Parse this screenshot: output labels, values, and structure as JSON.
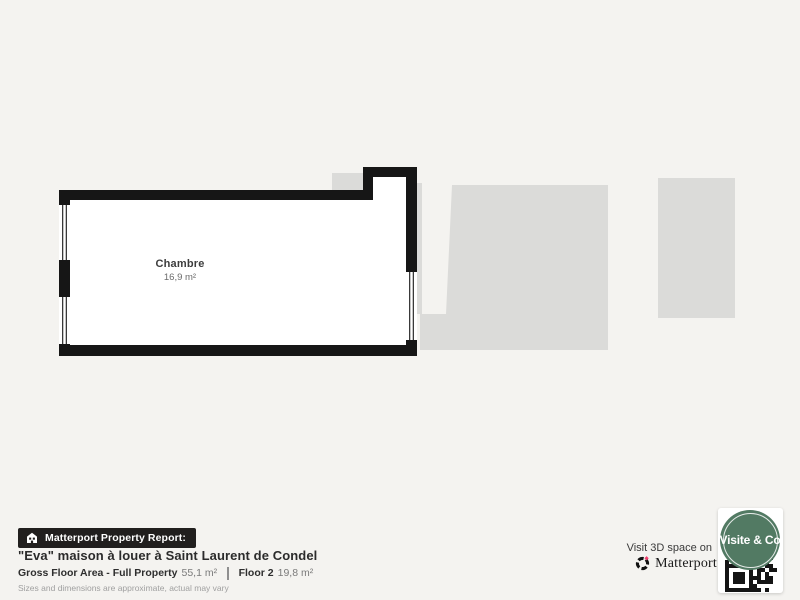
{
  "colors": {
    "background": "#f4f3f0",
    "area_gray": "#dbdbd9",
    "wall": "#161616",
    "room_fill": "#ffffff",
    "bar_bg": "#211f1e",
    "badge_green": "#527a63",
    "brand_pink": "#f23d6d",
    "text_dark": "#2e2e2e",
    "text_gray": "#7b7b7b"
  },
  "plan": {
    "room": {
      "name": "Chambre",
      "area": "16,9 m²"
    }
  },
  "footer": {
    "report_label": "Matterport Property Report:",
    "title": "\"Eva\" maison à louer à Saint Laurent de Condel",
    "stats": [
      {
        "label": "Gross Floor Area - Full Property",
        "value": "55,1 m²"
      },
      {
        "label": "Floor 2",
        "value": "19,8 m²"
      }
    ],
    "disclaimer": "Sizes and dimensions are approximate, actual may vary"
  },
  "cta": {
    "visit_text": "Visit 3D space on",
    "brand": "Matterport",
    "badge_text": "Visite & Co"
  }
}
